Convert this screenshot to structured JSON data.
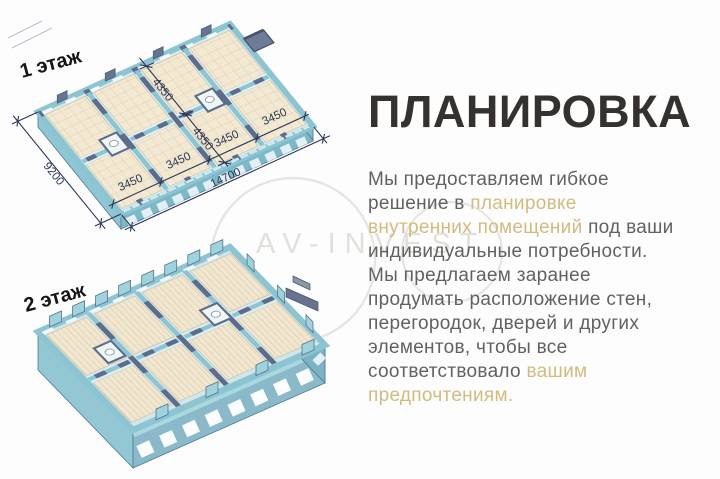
{
  "title": "ПЛАНИРОВКА",
  "paragraph": {
    "lines": [
      {
        "n": "Мы предоставляем гибкое"
      },
      {
        "n": "решение в ",
        "g": "планировке"
      },
      {
        "g": "внутренних помещений",
        "n": " под ваши"
      },
      {
        "n": "индивидуальные потребности."
      },
      {
        "n": "Мы предлагаем заранее"
      },
      {
        "n": "продумать расположение стен,"
      },
      {
        "n": "перегородок, дверей и других"
      },
      {
        "n": "элементов, чтобы все"
      },
      {
        "n": "соответствовало ",
        "g": "вашим"
      },
      {
        "g": "предпочтениям."
      }
    ]
  },
  "plans": {
    "plan1": {
      "label": "1 этаж",
      "dims": {
        "total_width": "14700",
        "total_depth": "9200",
        "unit_width": "3450",
        "room_depth": "4350"
      }
    },
    "plan2": {
      "label": "2 этаж"
    }
  },
  "watermark": {
    "text": "AV-INVEST"
  },
  "colors": {
    "accent_gold": "#d3ba7e",
    "title_dark": "#35312e",
    "body_gray": "#616161",
    "wall_teal": "#8cc4d2",
    "wall_side_teal": "#7bb3c5",
    "slate_blue": "#5d6c8b",
    "floor_beige": "#f3e9d2",
    "dimension_ink": "#2b3655"
  }
}
